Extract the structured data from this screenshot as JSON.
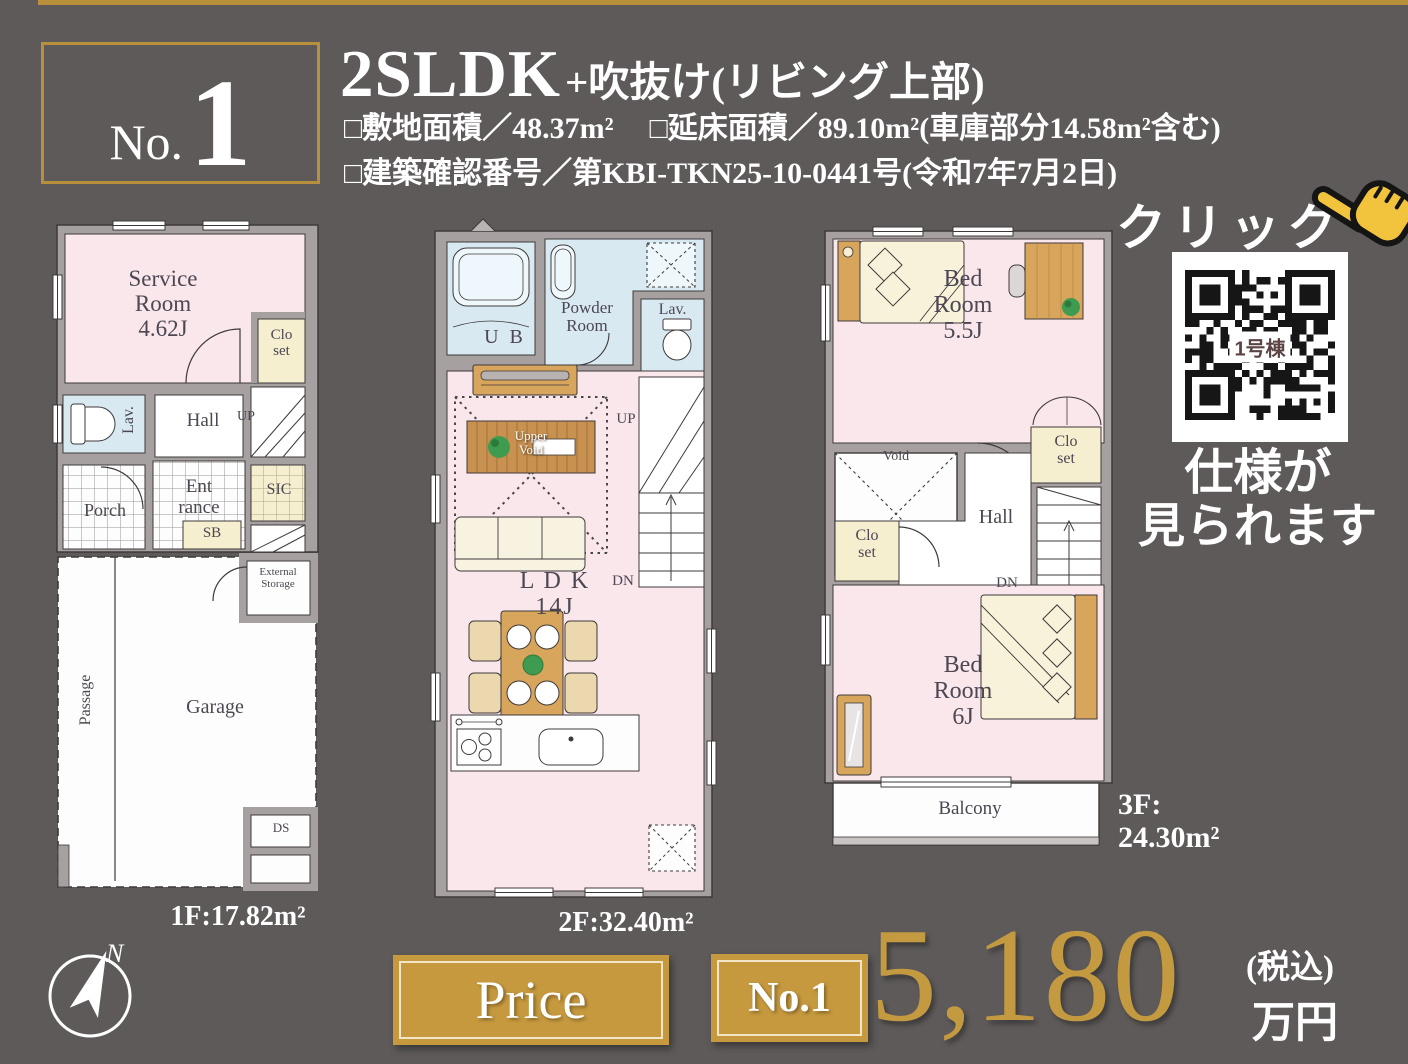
{
  "page": {
    "background": "#5e5a5a",
    "gold_accent": "#b8903c"
  },
  "badge": {
    "prefix": "No.",
    "number": "1"
  },
  "header": {
    "title_main": "2SLDK",
    "title_sub": "+吹抜け(リビング上部)",
    "spec1_left": "□敷地面積／48.37m²",
    "spec1_right": "□延床面積／89.10m²(車庫部分14.58m²含む)",
    "spec2": "□建築確認番号／第KBI-TKN25-10-0441号(令和7年7月2日)"
  },
  "qr_section": {
    "click_label": "クリック",
    "hand_icon": "pointing-hand-icon",
    "qr_center_label": "1号棟",
    "note_line1": "仕様が",
    "note_line2": "見られます"
  },
  "floors": {
    "f1": {
      "caption": "1F:17.82m²",
      "labels": {
        "service_room": "Service\nRoom\n4.62J",
        "closet": "Clo\nset",
        "lav": "Lav.",
        "hall": "Hall",
        "up": "UP",
        "entrance": "Ent\nrance",
        "sic": "SIC",
        "sb": "SB",
        "porch": "Porch",
        "passage": "Passage",
        "garage": "Garage",
        "external_storage": "External\nStorage",
        "ds": "DS"
      }
    },
    "f2": {
      "caption": "2F:32.40m²",
      "labels": {
        "ub": "U B",
        "powder_room": "Powder\nRoom",
        "lav": "Lav.",
        "up": "UP",
        "upper_void": "Upper\nVoid",
        "ldk": "L D K\n14J",
        "dn": "DN"
      }
    },
    "f3": {
      "caption": "3F:\n24.30m²",
      "labels": {
        "bedroom1": "Bed\nRoom\n5.5J",
        "void": "Void",
        "closet_right": "Clo\nset",
        "hall": "Hall",
        "closet_left": "Clo\nset",
        "dn": "DN",
        "bedroom2": "Bed\nRoom\n6J",
        "balcony": "Balcony"
      }
    }
  },
  "price": {
    "button_label": "Price",
    "badge_label": "No.1",
    "amount": "5,180",
    "tax_note": "(税込)",
    "unit": "万円"
  },
  "compass": {
    "north_label": "N"
  }
}
